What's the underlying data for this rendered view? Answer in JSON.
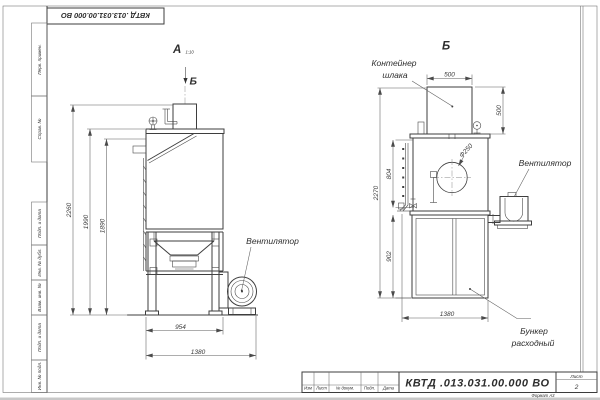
{
  "page": {
    "doc_number": "КВТД .013.031.00.000  ВО",
    "stamp_top": "КВТД .013.031.00.000  ВО",
    "sheet_label": "Лист",
    "sheet_value": "2",
    "format_note": "Формат А3",
    "revision_columns": {
      "c1": "Изм",
      "c2": "Лист",
      "c3": "№ докум.",
      "c4": "Подп.",
      "c5": "Дата"
    },
    "margin_fields": {
      "f1": "Перв. примен.",
      "f2": "Справ. №",
      "f3": "Подп. и дата",
      "f4": "Инв. № дубл.",
      "f5": "Взам. инв. №",
      "f6": "Подп. и дата",
      "f7": "Инв. № подл."
    }
  },
  "view_a": {
    "label": "А",
    "label_note": "1:10",
    "section_arrow": "Б",
    "callout_fan": "Вентилятор",
    "dims": {
      "h_total": "2260",
      "h_body": "1990",
      "h_inner": "1890",
      "w_body": "954",
      "w_total": "1380"
    }
  },
  "view_b": {
    "label": "Б",
    "callout_container_line1": "Контейнер",
    "callout_container_line2": "шлака",
    "callout_fan": "Вентилятор",
    "callout_bunker_line1": "Бункер",
    "callout_bunker_line2": "расходный",
    "dims": {
      "w_container": "500",
      "h_container": "500",
      "h_ladder": "804",
      "h_total": "2270",
      "h_bunker": "902",
      "w_bunker": "1380",
      "d_opening": "Ф250"
    }
  }
}
